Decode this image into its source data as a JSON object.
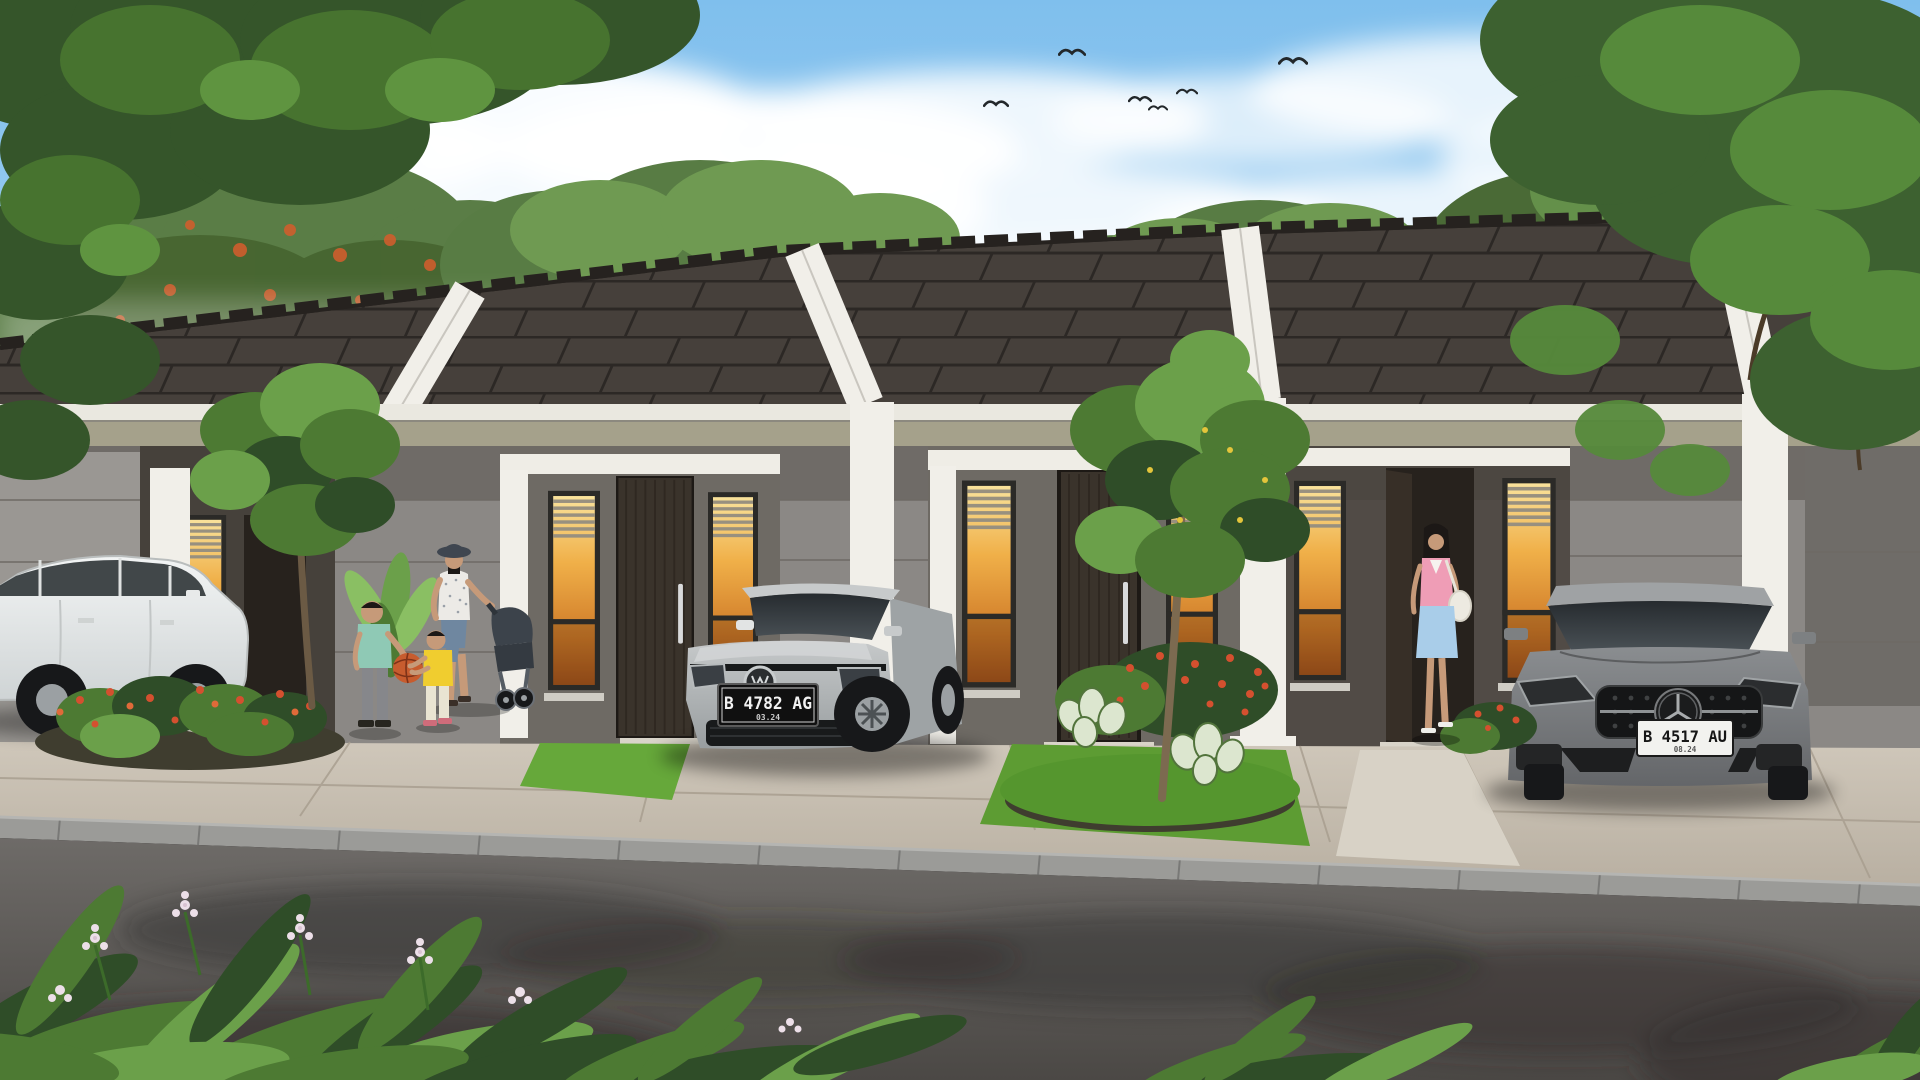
{
  "scene": {
    "type": "3D architectural rendering",
    "subject": "Row of modern single-storey minimalist houses with dark tiled roofs, white gable parapets, front gardens, parked cars and pedestrians under a blue sky",
    "sky": {
      "birds_count": 6,
      "clouds": true
    },
    "houses": {
      "count_visible": 4,
      "roof": "dark charcoal concrete tiles with ridge caps",
      "features": [
        "white diagonal gable parapets",
        "white entrance beams and pilasters",
        "tall narrow warm-lit windows with blinds",
        "dark timber front doors"
      ]
    },
    "vehicles": [
      {
        "name": "white-hatchback",
        "body_color": "white",
        "view": "side"
      },
      {
        "name": "silver-hatchback",
        "body_color": "silver",
        "view": "front-three-quarter",
        "license_plate": "B 4782 AG",
        "plate_expiry": "03.24",
        "plate_style": "white-on-black"
      },
      {
        "name": "gray-sedan",
        "body_color": "gray",
        "view": "front",
        "license_plate": "B 4517 AU",
        "plate_expiry": "08.24",
        "plate_style": "black-on-white"
      }
    ],
    "people": [
      {
        "name": "boy",
        "clothing": "teal t-shirt, grey trousers"
      },
      {
        "name": "toddler",
        "clothing": "yellow t-shirt, cream trousers",
        "holding": "orange ball with boy"
      },
      {
        "name": "mother",
        "clothing": "dark bucket hat, white sleeveless top, blue capri trousers",
        "pushing": "stroller"
      },
      {
        "name": "woman-at-door",
        "clothing": "pink top, light blue skirt, white shoulder bag"
      }
    ]
  },
  "colors": {
    "sky_top": "#7fbfed",
    "sky_horizon": "#cde6f6",
    "cloud": "#ffffff",
    "roof": "#46403b",
    "roof_line": "#2c2825",
    "roof_ridge": "#26221f",
    "parapet": "#f1efe9",
    "fascia": "#eae8e0",
    "soffit": "#a5a18b",
    "beam": "#efede6",
    "wall": "#8b8885",
    "wall_light": "#9a9793",
    "porch": "#46413b",
    "porch_mid": "#6e6a64",
    "recess": "#27221d",
    "sill": "#cfccc4",
    "door_wood": "#3a332b",
    "door_grain": "#2b241d",
    "window_frame": "#2b2a27",
    "window_glow_top": "#f9e29b",
    "window_glow_bottom": "#a8561c",
    "blind": "#98907f",
    "grass_light": "#69a93c",
    "grass_dark": "#4e8c2b",
    "soil": "#3f3d2f",
    "leaf_dark": "#2f4d28",
    "leaf_mid": "#4d7a33",
    "leaf_light": "#6ba04a",
    "leaf_bright": "#8abf63",
    "flower_red": "#d4502f",
    "flower_orange": "#e06a39",
    "flower_yellow": "#e4c53b",
    "flower_white_pink": "#ecdfe8",
    "caladium": "#dce6cf",
    "caladium_edge": "#52743c",
    "drive": "#c7bfb2",
    "drive_line": "#a79d8e",
    "walkway": "#d8d2c6",
    "curb": "#9b9b98",
    "road": "#656260",
    "road_shadow": "#2f2d2b",
    "trunk": "#6b5a44",
    "trunk2": "#7c6a50",
    "tire": "#17181a",
    "rim": "#9ba0a3",
    "glass": "#2e3439",
    "white_car": "#eef0f0",
    "silver_car": "#b6babb",
    "gray_car": "#797c7e",
    "plate_dark_bg": "#101010",
    "plate_dark_text": "#f2f2f2",
    "plate_light_bg": "#f2f2ef",
    "plate_light_text": "#161616",
    "skin": "#c69a79",
    "hat": "#3f4650",
    "mom_top": "#eceae6",
    "mom_pants": "#6f87a0",
    "stroller": "#3c434b",
    "boy_shirt": "#8fc9b5",
    "boy_pants": "#86878b",
    "toddler_shirt": "#f0cd2f",
    "toddler_pants": "#e9e4d2",
    "ball": "#c75c2e",
    "woman_top": "#ef9db6",
    "woman_skirt": "#a9cde9",
    "bag": "#edeae1",
    "hair": "#1c1816",
    "bird": "#23282b"
  }
}
